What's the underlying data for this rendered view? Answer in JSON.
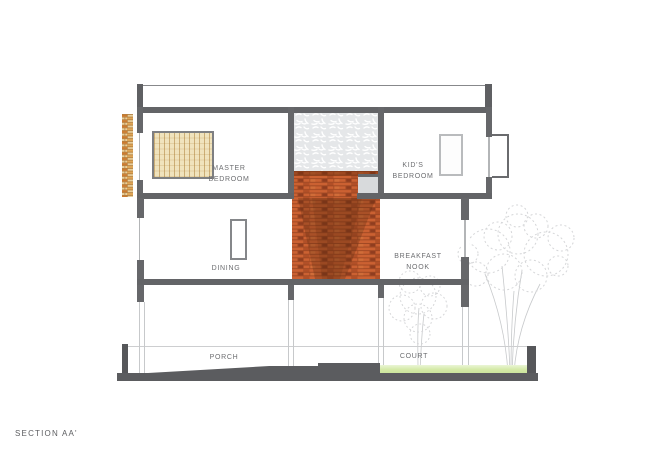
{
  "drawing": {
    "title": "SECTION AA'",
    "labels": {
      "master_bedroom": "MASTER\nBEDROOM",
      "kids_bedroom": "KID'S\nBEDROOM",
      "dining": "DINING",
      "breakfast_nook": "BREAKFAST\nNOOK",
      "porch": "PORCH",
      "court": "COURT"
    },
    "colors": {
      "wall_gray": "#66676a",
      "slab_gray": "#636467",
      "brick_orange": "#cb6132",
      "brick_mortar": "#9c4622",
      "timber_screen_tan": "#e8cf9c",
      "jali_screen_gray": "#e5e7e9",
      "grass_green": "#d5eaa8",
      "ground_gray": "#595a5d",
      "tree_sketch_gray": "#d2d4d6",
      "label_text_gray": "#6d6e71"
    }
  }
}
